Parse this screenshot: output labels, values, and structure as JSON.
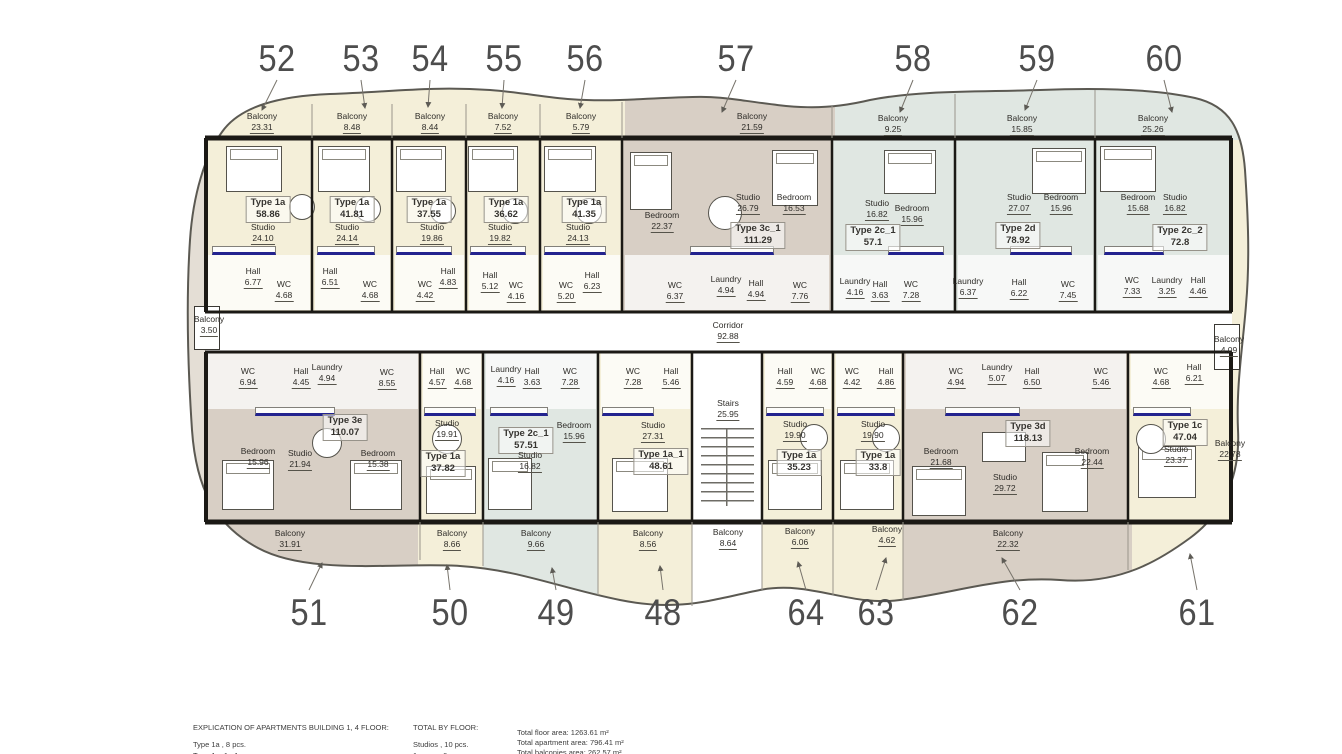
{
  "plan": {
    "corridor": {
      "n": "Corridor",
      "a": "92.88"
    },
    "stairs": {
      "n": "Stairs",
      "a": "25.95"
    },
    "side_balconies": {
      "left": {
        "n": "Balcony",
        "a": "3.50"
      },
      "right": {
        "n": "Balcony",
        "a": "4.09"
      },
      "stairs": {
        "n": "Balcony",
        "a": "8.64"
      }
    },
    "units": [
      {
        "no": "52",
        "type": "Type 1a",
        "area": "58.86",
        "balcony": {
          "n": "Balcony",
          "a": "23.31"
        },
        "rooms": [
          {
            "n": "Studio",
            "a": "24.10"
          },
          {
            "n": "Hall",
            "a": "6.77"
          },
          {
            "n": "WC",
            "a": "4.68"
          }
        ]
      },
      {
        "no": "53",
        "type": "Type 1a",
        "area": "41.81",
        "balcony": {
          "n": "Balcony",
          "a": "8.48"
        },
        "rooms": [
          {
            "n": "Studio",
            "a": "24.14"
          },
          {
            "n": "Hall",
            "a": "6.51"
          },
          {
            "n": "WC",
            "a": "4.68"
          }
        ]
      },
      {
        "no": "54",
        "type": "Type 1a",
        "area": "37.55",
        "balcony": {
          "n": "Balcony",
          "a": "8.44"
        },
        "rooms": [
          {
            "n": "Studio",
            "a": "19.86"
          },
          {
            "n": "WC",
            "a": "4.42"
          },
          {
            "n": "Hall",
            "a": "4.83"
          }
        ]
      },
      {
        "no": "55",
        "type": "Type 1a",
        "area": "36.62",
        "balcony": {
          "n": "Balcony",
          "a": "7.52"
        },
        "rooms": [
          {
            "n": "Studio",
            "a": "19.82"
          },
          {
            "n": "Hall",
            "a": "5.12"
          },
          {
            "n": "WC",
            "a": "4.16"
          }
        ]
      },
      {
        "no": "56",
        "type": "Type 1a",
        "area": "41.35",
        "balcony": {
          "n": "Balcony",
          "a": "5.79"
        },
        "rooms": [
          {
            "n": "Studio",
            "a": "24.13"
          },
          {
            "n": "WC",
            "a": "5.20"
          },
          {
            "n": "Hall",
            "a": "6.23"
          }
        ]
      },
      {
        "no": "57",
        "type": "Type 3c_1",
        "area": "111.29",
        "balcony": {
          "n": "Balcony",
          "a": "21.59"
        },
        "rooms": [
          {
            "n": "Bedroom",
            "a": "22.37"
          },
          {
            "n": "Studio",
            "a": "26.79"
          },
          {
            "n": "Bedroom",
            "a": "16.53"
          },
          {
            "n": "WC",
            "a": "6.37"
          },
          {
            "n": "Laundry",
            "a": "4.94"
          },
          {
            "n": "Hall",
            "a": "4.94"
          },
          {
            "n": "WC",
            "a": "7.76"
          }
        ]
      },
      {
        "no": "58",
        "type": "Type 2c_1",
        "area": "57.1",
        "balcony": {
          "n": "Balcony",
          "a": "9.25"
        },
        "rooms": [
          {
            "n": "Studio",
            "a": "16.82"
          },
          {
            "n": "Bedroom",
            "a": "15.96"
          },
          {
            "n": "Laundry",
            "a": "4.16"
          },
          {
            "n": "Hall",
            "a": "3.63"
          },
          {
            "n": "WC",
            "a": "7.28"
          }
        ]
      },
      {
        "no": "59",
        "type": "Type 2d",
        "area": "78.92",
        "balcony": {
          "n": "Balcony",
          "a": "15.85"
        },
        "rooms": [
          {
            "n": "Studio",
            "a": "27.07"
          },
          {
            "n": "Bedroom",
            "a": "15.96"
          },
          {
            "n": "Laundry",
            "a": "6.37"
          },
          {
            "n": "Hall",
            "a": "6.22"
          },
          {
            "n": "WC",
            "a": "7.45"
          }
        ]
      },
      {
        "no": "60",
        "type": "Type 2c_2",
        "area": "72.8",
        "balcony": {
          "n": "Balcony",
          "a": "25.26"
        },
        "rooms": [
          {
            "n": "Bedroom",
            "a": "15.68"
          },
          {
            "n": "Studio",
            "a": "16.82"
          },
          {
            "n": "WC",
            "a": "7.33"
          },
          {
            "n": "Laundry",
            "a": "3.25"
          },
          {
            "n": "Hall",
            "a": "4.46"
          }
        ]
      },
      {
        "no": "51",
        "type": "Type 3e",
        "area": "110.07",
        "balcony": {
          "n": "Balcony",
          "a": "31.91"
        },
        "rooms": [
          {
            "n": "WC",
            "a": "6.94"
          },
          {
            "n": "Hall",
            "a": "4.45"
          },
          {
            "n": "Laundry",
            "a": "4.94"
          },
          {
            "n": "WC",
            "a": "8.55"
          },
          {
            "n": "Bedroom",
            "a": "15.96"
          },
          {
            "n": "Studio",
            "a": "21.94"
          },
          {
            "n": "Bedroom",
            "a": "15.38"
          }
        ]
      },
      {
        "no": "50",
        "type": "Type 1a",
        "area": "37.82",
        "balcony": {
          "n": "Balcony",
          "a": "8.66"
        },
        "rooms": [
          {
            "n": "Hall",
            "a": "4.57"
          },
          {
            "n": "WC",
            "a": "4.68"
          },
          {
            "n": "Studio",
            "a": "19.91"
          }
        ]
      },
      {
        "no": "49",
        "type": "Type 2c_1",
        "area": "57.51",
        "balcony": {
          "n": "Balcony",
          "a": "9.66"
        },
        "rooms": [
          {
            "n": "Laundry",
            "a": "4.16"
          },
          {
            "n": "Hall",
            "a": "3.63"
          },
          {
            "n": "WC",
            "a": "7.28"
          },
          {
            "n": "Studio",
            "a": "16.82"
          },
          {
            "n": "Bedroom",
            "a": "15.96"
          }
        ]
      },
      {
        "no": "48",
        "type": "Type 1a_1",
        "area": "48.61",
        "balcony": {
          "n": "Balcony",
          "a": "8.56"
        },
        "rooms": [
          {
            "n": "WC",
            "a": "7.28"
          },
          {
            "n": "Hall",
            "a": "5.46"
          },
          {
            "n": "Studio",
            "a": "27.31"
          }
        ]
      },
      {
        "no": "64",
        "type": "Type 1a",
        "area": "35.23",
        "balcony": {
          "n": "Balcony",
          "a": "6.06"
        },
        "rooms": [
          {
            "n": "Hall",
            "a": "4.59"
          },
          {
            "n": "WC",
            "a": "4.68"
          },
          {
            "n": "Studio",
            "a": "19.90"
          }
        ]
      },
      {
        "no": "63",
        "type": "Type 1a",
        "area": "33.8",
        "balcony": {
          "n": "Balcony",
          "a": "4.62"
        },
        "rooms": [
          {
            "n": "WC",
            "a": "4.42"
          },
          {
            "n": "Hall",
            "a": "4.86"
          },
          {
            "n": "Studio",
            "a": "19.90"
          }
        ]
      },
      {
        "no": "62",
        "type": "Type 3d",
        "area": "118.13",
        "balcony": {
          "n": "Balcony",
          "a": "22.32"
        },
        "rooms": [
          {
            "n": "WC",
            "a": "4.94"
          },
          {
            "n": "Laundry",
            "a": "5.07"
          },
          {
            "n": "Hall",
            "a": "6.50"
          },
          {
            "n": "WC",
            "a": "5.46"
          },
          {
            "n": "Bedroom",
            "a": "21.68"
          },
          {
            "n": "Studio",
            "a": "29.72"
          },
          {
            "n": "Bedroom",
            "a": "22.44"
          }
        ]
      },
      {
        "no": "61",
        "type": "Type 1c",
        "area": "47.04",
        "balcony": {
          "n": "Balcony",
          "a": "22.78"
        },
        "rooms": [
          {
            "n": "WC",
            "a": "4.68"
          },
          {
            "n": "Hall",
            "a": "6.21"
          },
          {
            "n": "Studio",
            "a": "23.37"
          }
        ]
      }
    ]
  },
  "footer": {
    "explication_title": "EXPLICATION OF APARTMENTS BUILDING 1, 4 FLOOR:",
    "explication_line1": "Type 1a , 8 pcs.",
    "explication_line2": "Type 1a_1 , 1 pcs.",
    "total_title": "TOTAL BY FLOOR:",
    "total_line1": "Studios , 10 pcs.",
    "total_line2": "1-room , 6 pcs.",
    "areas": [
      "Total floor area: 1263.61 m²",
      "Total apartment area: 796.41 m²",
      "Total balconies area: 262.57 m²"
    ]
  }
}
